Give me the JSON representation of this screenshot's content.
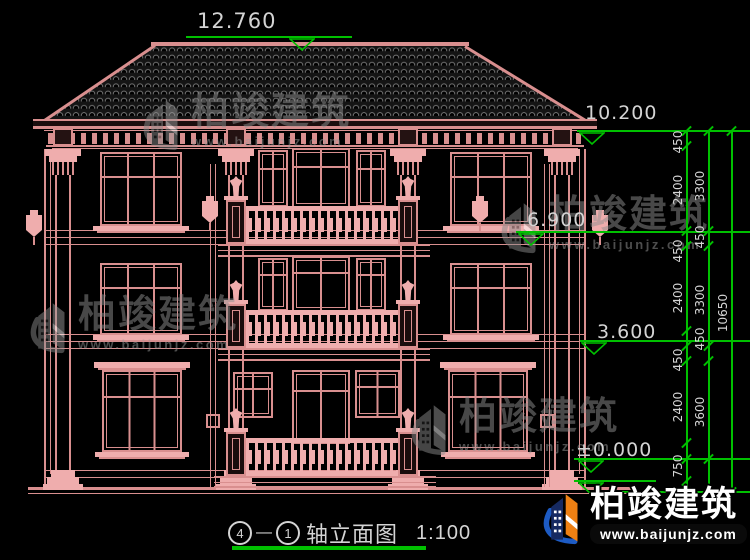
{
  "drawing": {
    "title": {
      "axis_start": "4",
      "separator": "—",
      "axis_end": "1",
      "name": "轴立面图",
      "scale": "1:100"
    },
    "elevation_markers": [
      {
        "value": "12.760"
      },
      {
        "value": "10.200"
      },
      {
        "value": "6.900"
      },
      {
        "value": "3.600"
      },
      {
        "value": "±0.000"
      }
    ],
    "dimension_chains": {
      "inner": [
        "450",
        "2400",
        "450",
        "2400",
        "450",
        "2400",
        "750"
      ],
      "middle": [
        "3300",
        "450",
        "3300",
        "450",
        "3600"
      ],
      "outer": [
        "10650"
      ]
    }
  },
  "watermark": {
    "brand": "柏竣建筑",
    "url": "www.baijunjz.com"
  },
  "logo": {
    "brand": "柏竣建筑",
    "url": "www.baijunjz.com"
  },
  "colors": {
    "line_pink": "#d98f8f",
    "fill_pink": "#efadad",
    "dim_green": "#00c000",
    "cad_text": "#d4d4d4",
    "tile_gray": "#8f8f8f",
    "watermark_gray": "#8c8c8c",
    "logo_navy": "#162a62",
    "logo_orange": "#ee8013",
    "logo_blue": "#1d5bc4"
  }
}
